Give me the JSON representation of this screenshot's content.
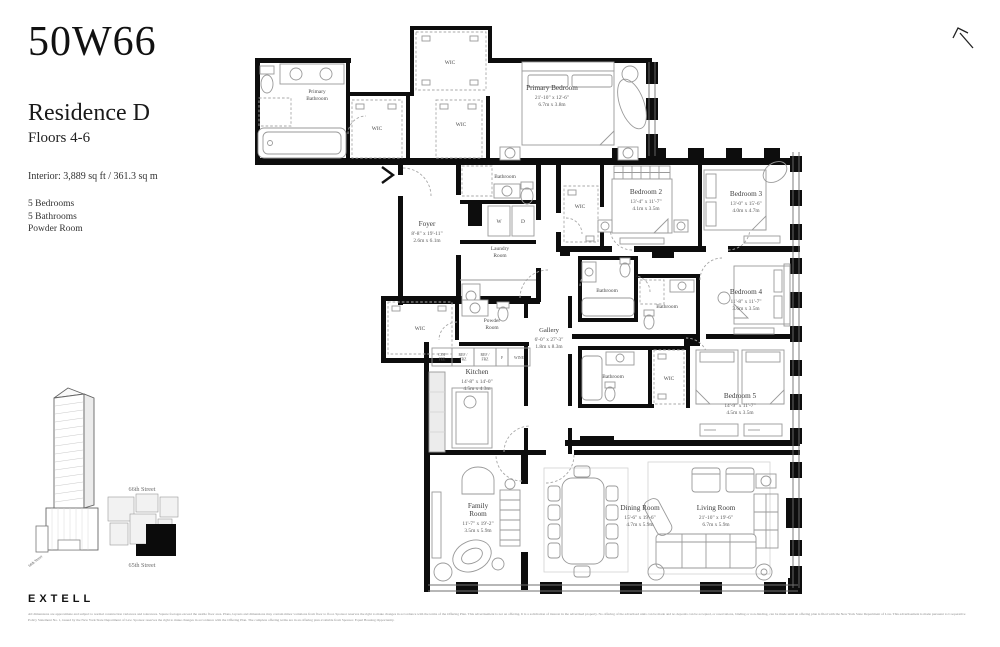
{
  "header": {
    "brand": "50W66",
    "residence": "Residence D",
    "floors": "Floors 4-6",
    "interior": "Interior: 3,889 sq ft / 361.3 sq m",
    "features": [
      "5 Bedrooms",
      "5 Bathrooms",
      "Powder Room"
    ]
  },
  "plan": {
    "rooms": {
      "primary_bathroom": {
        "lines": [
          "Primary",
          "Bathroom"
        ]
      },
      "wic_top": {
        "lines": [
          "WIC"
        ]
      },
      "wic_mid": {
        "lines": [
          "WIC"
        ]
      },
      "wic_primary": {
        "lines": [
          "WIC"
        ]
      },
      "primary_bedroom": {
        "lines": [
          "Primary Bedroom",
          "21'-10\" x 12'-6\"",
          "6.7m x 3.8m"
        ]
      },
      "bathroom_foyer": {
        "lines": [
          "Bathroom"
        ]
      },
      "washer": {
        "lines": [
          "W"
        ]
      },
      "dryer": {
        "lines": [
          "D"
        ]
      },
      "laundry": {
        "lines": [
          "Laundry",
          "Room"
        ]
      },
      "foyer": {
        "lines": [
          "Foyer",
          "8'-8\" x 19'-11\"",
          "2.6m x 6.1m"
        ]
      },
      "wic_bedroom2": {
        "lines": [
          "WIC"
        ]
      },
      "bedroom2": {
        "lines": [
          "Bedroom 2",
          "13'-4\" x 11'-7\"",
          "4.1m x 3.5m"
        ]
      },
      "bedroom3": {
        "lines": [
          "Bedroom 3",
          "13'-0\" x 15'-6\"",
          "4.0m x 4.7m"
        ]
      },
      "bathroom_hall": {
        "lines": [
          "Bathroom"
        ]
      },
      "bathroom_bedroom4": {
        "lines": [
          "Bathroom"
        ]
      },
      "bedroom4": {
        "lines": [
          "Bedroom 4",
          "11'-8\" x 11'-7\"",
          "3.6m x 3.5m"
        ]
      },
      "wic_powder": {
        "lines": [
          "WIC"
        ]
      },
      "powder": {
        "lines": [
          "Powder",
          "Room"
        ]
      },
      "gallery": {
        "lines": [
          "Gallery",
          "6'-0\" x 27'-3\"",
          "1.8m x 8.3m"
        ]
      },
      "kitchen": {
        "lines": [
          "Kitchen",
          "14'-8\" x 14'-0\"",
          "4.5m x 4.3m"
        ]
      },
      "bathroom_bedroom5": {
        "lines": [
          "Bathroom"
        ]
      },
      "wic_bedroom5": {
        "lines": [
          "WIC"
        ]
      },
      "bedroom5": {
        "lines": [
          "Bedroom 5",
          "14'-9\" x 11'-7\"",
          "4.5m x 3.5m"
        ]
      },
      "family_room": {
        "lines": [
          "Family",
          "Room",
          "11'-7\" x 19'-2\"",
          "3.5m x 5.9m"
        ]
      },
      "dining_room": {
        "lines": [
          "Dining Room",
          "15'-6\" x 19'-6\"",
          "4.7m x 5.9m"
        ]
      },
      "living_room": {
        "lines": [
          "Living Room",
          "21'-10\" x 19'-6\"",
          "6.7m x 5.9m"
        ]
      }
    },
    "kitchen_appliances": [
      [
        "COF",
        "FEE"
      ],
      [
        "REF /",
        "FRZ"
      ],
      [
        "REF /",
        "FRZ"
      ],
      [
        "F"
      ],
      [
        "WINE"
      ]
    ]
  },
  "keyplan": {
    "street_top": "66th Street",
    "street_bottom": "65th Street",
    "tower_street": "66th Street"
  },
  "footer": {
    "logo": "EXTELL",
    "disclaimer": "All dimensions are approximate and subject to normal construction variances and tolerances. Square footages exceed the usable floor area. Plans, layouts and dimensions may contain minor variations from floor to floor. Sponsor reserves the right to make changes in accordance with the terms of the Offering Plan. This advertisement is not an offering. It is a solicitation of interest in the advertised property. No offering of the advertised units can be made and no deposits can be accepted, or reservations, binding or non-binding, can be made until an offering plan is filed with the New York State Department of Law. This advertisement is made pursuant to Cooperative Policy Statement No. 1, issued by the New York State Department of Law. Sponsor reserves the right to make changes in accordance with the Offering Plan. The complete offering terms are in an offering plan available from Sponsor. Equal Housing Opportunity."
  }
}
